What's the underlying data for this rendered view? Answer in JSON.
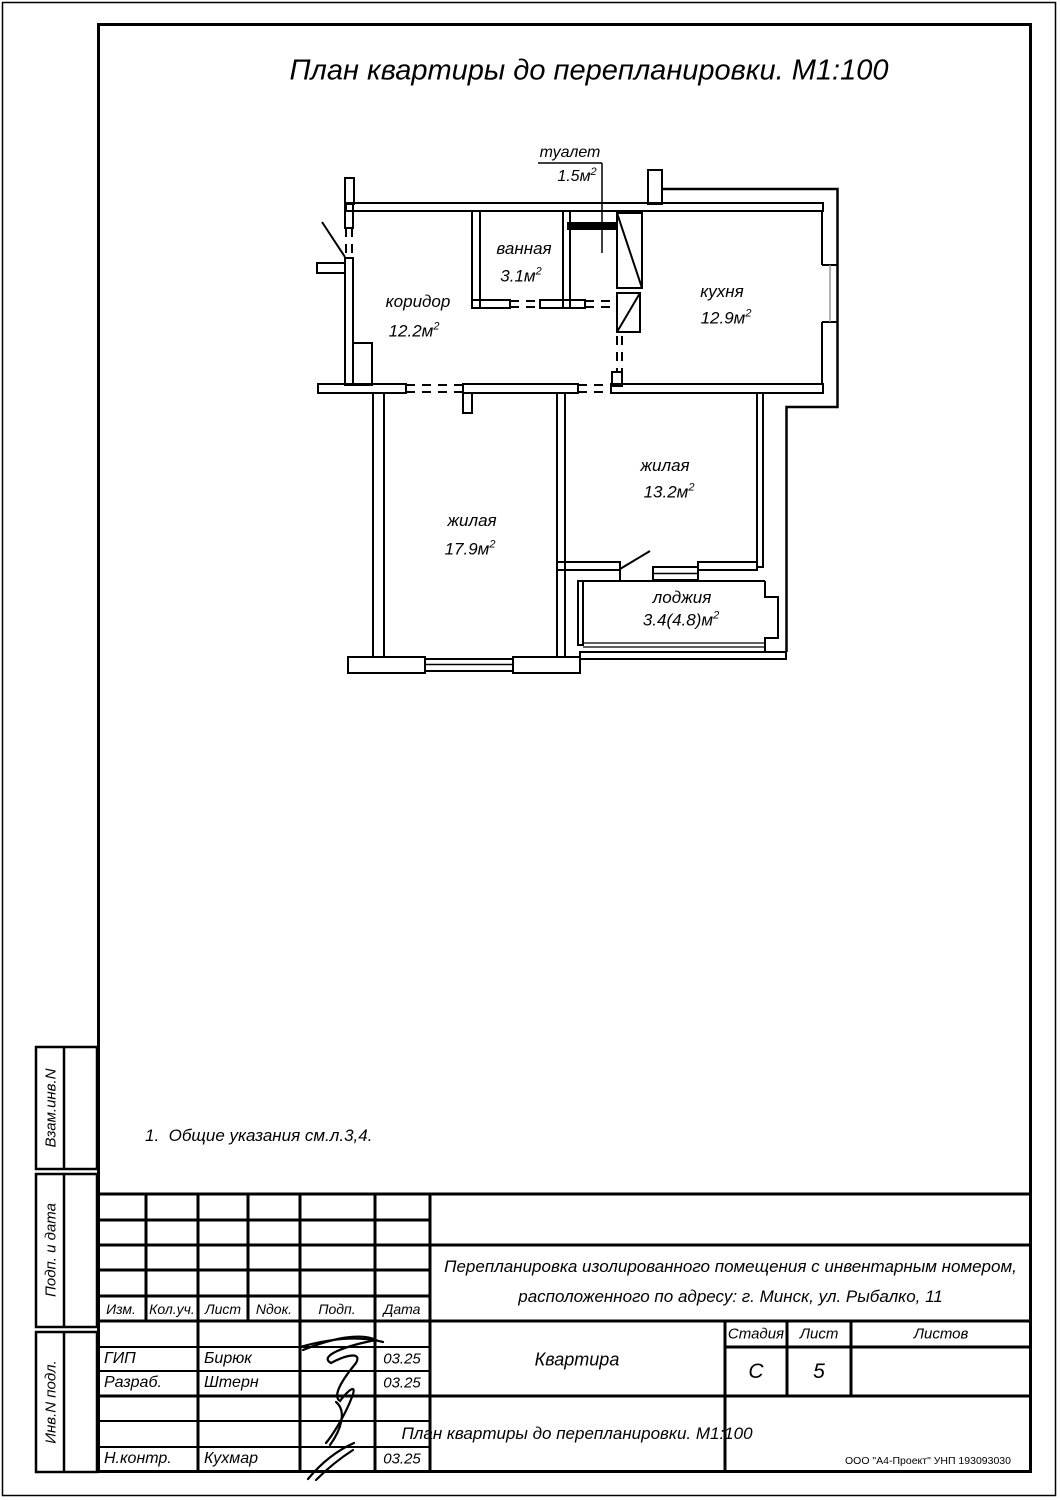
{
  "page_title": "План квартиры до перепланировки. М1:100",
  "note": "1.  Общие указания см.л.3,4.",
  "plan": {
    "rooms": [
      {
        "name": "туалет",
        "area": "1.5м",
        "sup": "2"
      },
      {
        "name": "ванная",
        "area": "3.1м",
        "sup": "2"
      },
      {
        "name": "коридор",
        "area": "12.2м",
        "sup": "2"
      },
      {
        "name": "кухня",
        "area": "12.9м",
        "sup": "2"
      },
      {
        "name": "жилая",
        "area": "13.2м",
        "sup": "2"
      },
      {
        "name": "жилая",
        "area": "17.9м",
        "sup": "2"
      },
      {
        "name": "лоджия",
        "area": "3.4(4.8)м",
        "sup": "2"
      }
    ]
  },
  "side_strip": {
    "labels": [
      "Взам.инв.N",
      "Подп. и дата",
      "Инв.N подл."
    ]
  },
  "title_block": {
    "header_cols": [
      "Изм.",
      "Кол.уч.",
      "Лист",
      "Nдок.",
      "Подп.",
      "Дата"
    ],
    "rows": [
      {
        "role": "ГИП",
        "name": "Бирюк",
        "date": "03.25"
      },
      {
        "role": "Разраб.",
        "name": "Штерн",
        "date": "03.25"
      },
      {
        "role": "Н.контр.",
        "name": "Кухмар",
        "date": "03.25"
      }
    ],
    "project_line1": "Перепланировка изолированного помещения с инвентарным номером,",
    "project_line2": "расположенного по адресу: г. Минск, ул. Рыбалко, 11",
    "object_name": "Квартира",
    "stage_label": "Стадия",
    "sheet_label": "Лист",
    "sheets_label": "Листов",
    "stage_value": "С",
    "sheet_value": "5",
    "sheets_value": "",
    "drawing_title": "План квартиры до перепланировки. М1:100",
    "company": "ООО \"А4-Проект\" УНП 193093030"
  }
}
